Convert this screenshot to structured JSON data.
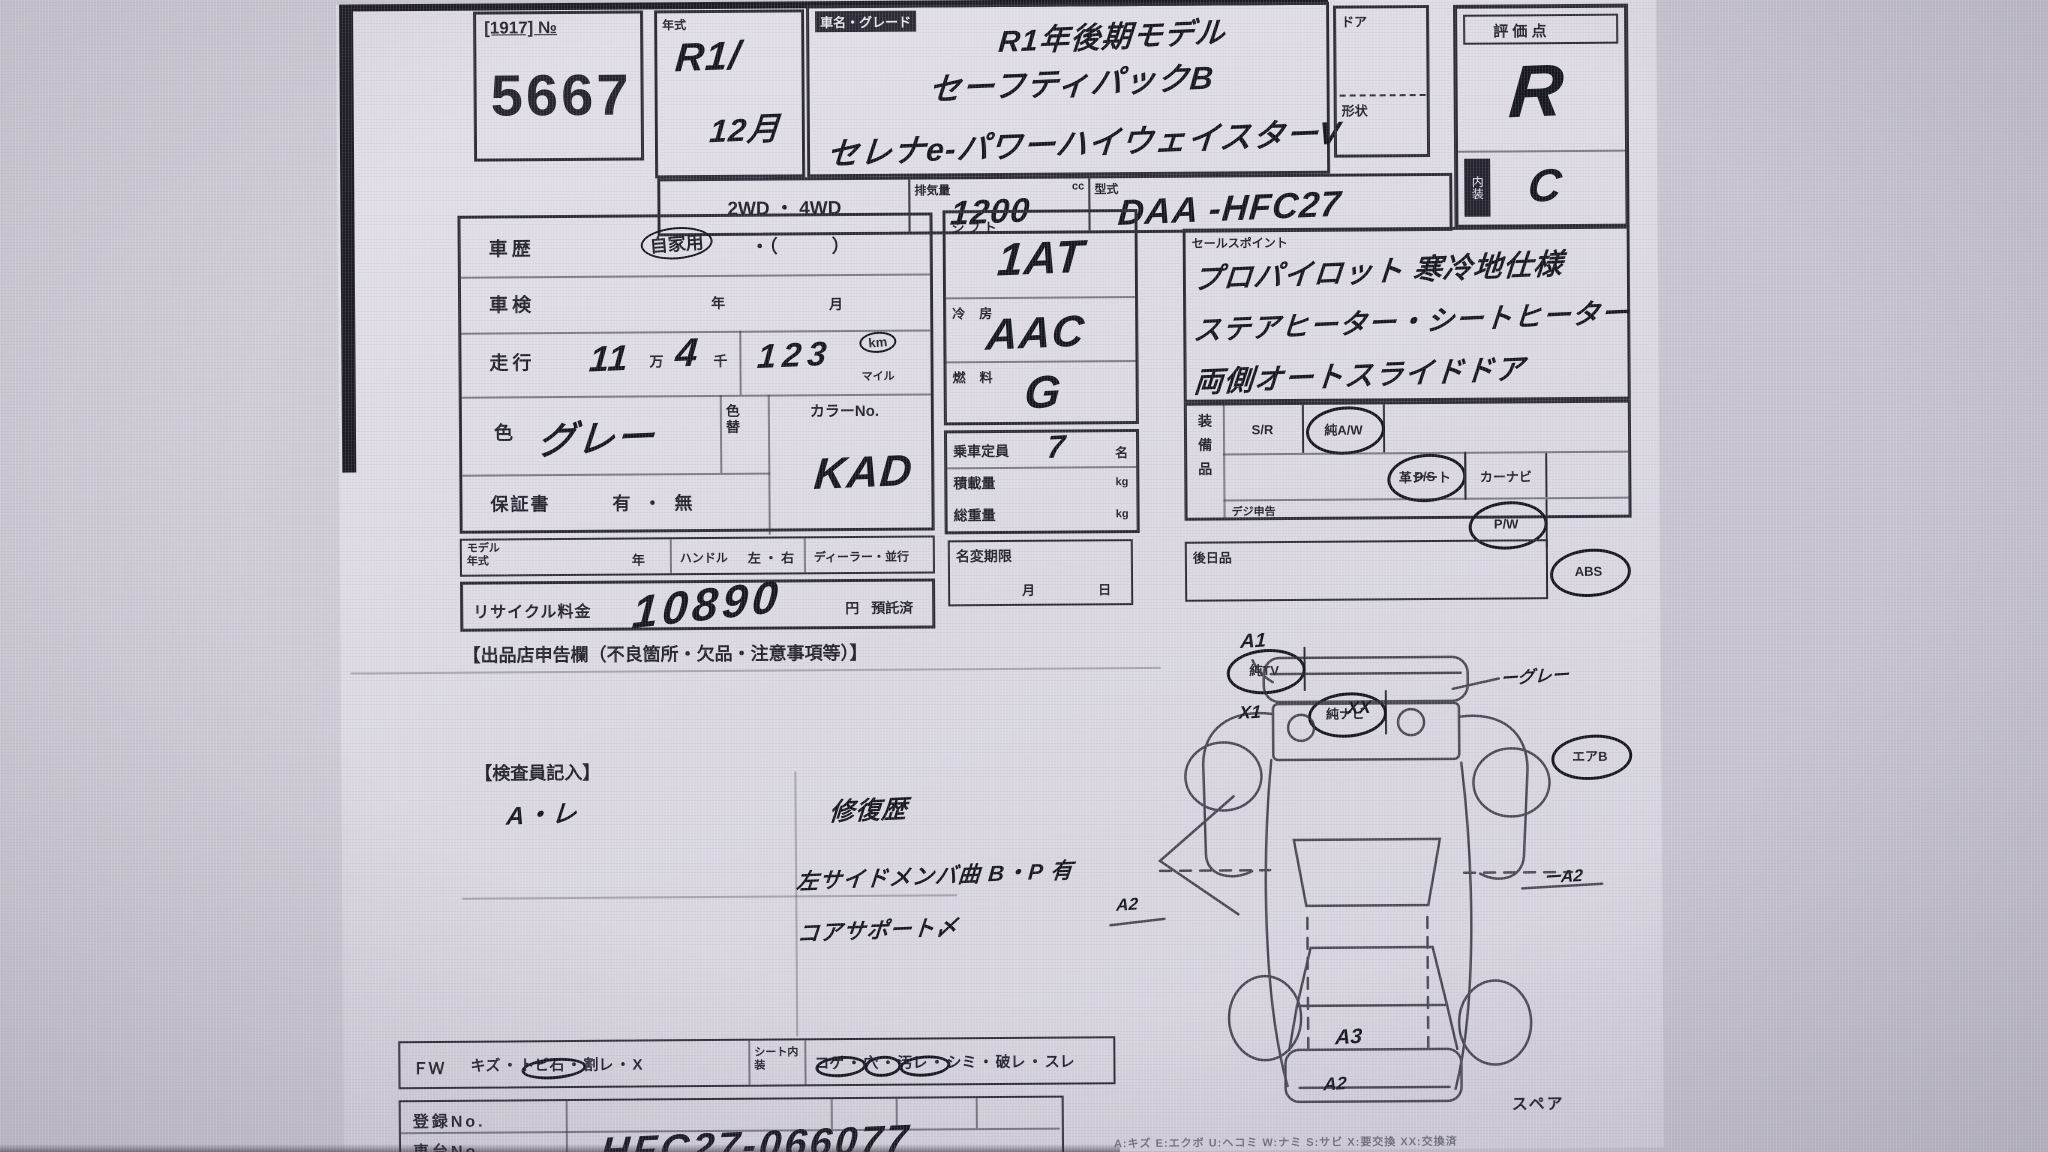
{
  "header": {
    "lot_tag": "[1917] №",
    "lot_number": "5667",
    "year_label": "年式",
    "year_line1": "R1/",
    "year_line2": "12月",
    "grade_label": "車名・グレード",
    "grade_line1": "R1年後期モデル",
    "grade_line2": "セーフティパックB",
    "grade_line3": "セレナe-パワーハイウェイスターV",
    "door_label": "ドア",
    "shape_label": "形状",
    "drive_options": "2WD ・ 4WD",
    "disp_label": "排気量",
    "disp_unit": "cc",
    "disp_value": "1200",
    "model_label": "型式",
    "model_value": "DAA -HFC27",
    "score_label": "評 価 点",
    "score_value": "R",
    "interior_label": "内装",
    "interior_value": "C"
  },
  "left": {
    "history_label": "車歴",
    "history_value": "自家用",
    "history_paren": "・（　　　）",
    "shaken_label": "車検",
    "year_unit": "年",
    "month_unit": "月",
    "run_label": "走行",
    "run_man": "11",
    "man_unit": "万",
    "run_sen": "4",
    "sen_unit": "千",
    "run_num": "123",
    "km_label": "km",
    "mile_label": "マイル",
    "color_label": "色",
    "color_value": "グレー",
    "colorchg_label": "色替",
    "colorno_label": "カラーNo.",
    "colorno_value": "KAD",
    "warranty_label": "保証書",
    "warranty_options": "有 ・ 無",
    "modelyear_label": "モデル年式",
    "modelyear_unit": "年",
    "handle_label": "ハンドル",
    "handle_options": "左 ・ 右",
    "dealer_label": "ディーラー・並行",
    "recycle_label": "リサイクル料金",
    "recycle_value": "10890",
    "recycle_unit": "円",
    "recycle_paid": "預託済",
    "declare_title": "【出品店申告欄（不良箇所・欠品・注意事項等）】"
  },
  "center": {
    "shift_label": "シフト",
    "shift_value": "1AT",
    "ac_label": "冷房",
    "ac_value": "AAC",
    "fuel_label": "燃料",
    "fuel_value": "G",
    "pax_label": "乗車定員",
    "pax_value": "7",
    "pax_unit": "名",
    "load_label": "積載量",
    "load_unit": "kg",
    "gw_label": "総重量",
    "gw_unit": "kg",
    "transfer_label": "名変期限",
    "transfer_month": "月",
    "transfer_day": "日"
  },
  "sales": {
    "label": "セールスポイント",
    "line1": "プロパイロット 寒冷地仕様",
    "line2": "ステアヒーター・シートヒーター",
    "line3": "両側オートスライドドア"
  },
  "equip": {
    "label": "装備品",
    "row1": [
      {
        "t": "S/R",
        "c": false
      },
      {
        "t": "純A/W",
        "c": true
      },
      {
        "t": "P/S",
        "c": true
      },
      {
        "t": "P/W",
        "c": true
      },
      {
        "t": "ABS",
        "c": true
      }
    ],
    "row2": [
      {
        "t": "純TV",
        "c": true
      },
      {
        "t": "純ナビ",
        "c": true
      },
      {
        "t": "革シート",
        "c": false
      },
      {
        "t": "カーナビ",
        "c": false
      },
      {
        "t": "エアB",
        "c": true
      }
    ],
    "note": "デジ申告"
  },
  "later": {
    "label": "後日品"
  },
  "inspector": {
    "label": "【検査員記入】",
    "left_note": "A・レ",
    "note1": "修復歴",
    "note2": "左サイドメンバ曲 B・P 有",
    "note3": "コアサポート〆"
  },
  "diagram": {
    "marks": [
      "A1",
      "X1",
      "XX",
      "ーグレー",
      "A2",
      "ーA2",
      "A3",
      "A2"
    ],
    "spare": "スペア"
  },
  "bottom": {
    "fw_label": "ＦＷ",
    "fw_items": [
      {
        "t": "キズ",
        "c": false
      },
      {
        "t": "トビ石",
        "c": true
      },
      {
        "t": "割レ",
        "c": false
      },
      {
        "t": "X",
        "c": false
      }
    ],
    "seat_label": "シート内装",
    "seat_items": [
      {
        "t": "コゲ",
        "c": true
      },
      {
        "t": "穴",
        "c": true
      },
      {
        "t": "汚レ",
        "c": true
      },
      {
        "t": "シミ",
        "c": false
      },
      {
        "t": "破レ",
        "c": false
      },
      {
        "t": "スレ",
        "c": false
      }
    ],
    "reg_label": "登録No.",
    "chassis_label": "車台No.",
    "chassis_value": "HFC27-066077",
    "legend": "A:キズ E:エクボ U:ヘコミ W:ナミ S:サビ X:要交換 XX:交換済"
  }
}
